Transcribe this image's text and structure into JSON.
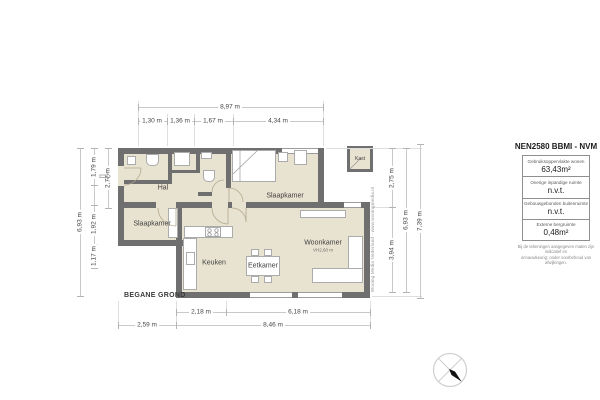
{
  "plan": {
    "floor_label": "BEGANE GROND",
    "entrance_arrow": "⇨",
    "rooms": {
      "hal": "Hal",
      "slaapkamer_left": "Slaapkamer",
      "slaapkamer_top": "Slaapkamer",
      "keuken": "Keuken",
      "eetkamer": "Eetkamer",
      "woonkamer": "Woonkamer",
      "woonkamer_ceiling_height": "VH2,60 m",
      "kast": "Kast"
    },
    "watermark": "Woning Media Nederland - www.woningmedia.nl"
  },
  "dimensions": {
    "top": {
      "total": "8,97 m",
      "segments": [
        "1,30 m",
        "1,36 m",
        "1,67 m",
        "4,34 m"
      ]
    },
    "left": {
      "total": "6,93 m",
      "segments": [
        "1,79 m",
        "1,92 m",
        "1,17 m"
      ],
      "upper_depth": "2,77 m"
    },
    "right": {
      "segments": [
        "2,75 m",
        "3,94 m"
      ],
      "total": "6,93 m",
      "overall": "7,39 m"
    },
    "bottom": {
      "segments": [
        "2,18 m",
        "6,18 m"
      ],
      "left": "2,59 m",
      "total": "8,46 m"
    }
  },
  "legend": {
    "title": "NEN2580 BBMI - NVM",
    "rows": [
      {
        "label": "Gebruiksoppervlakte wonen",
        "value": "63,43m²"
      },
      {
        "label": "Overige inpandige ruimte",
        "value": "n.v.t."
      },
      {
        "label": "Gebouwgebonden buitenruimte",
        "value": "n.v.t."
      },
      {
        "label": "Externe bergruimte",
        "value": "0,48m²"
      }
    ],
    "disclaimer": [
      "Bij de tekeningen aangegeven maten zijn indicatief en",
      "onnauwkeurig; onder voorbehoud van afwijkingen."
    ]
  },
  "colors": {
    "wall": "#6f6f6f",
    "floor": "#e8e2d0",
    "dim_line": "#c9c9c9",
    "text": "#3f3f3f"
  }
}
